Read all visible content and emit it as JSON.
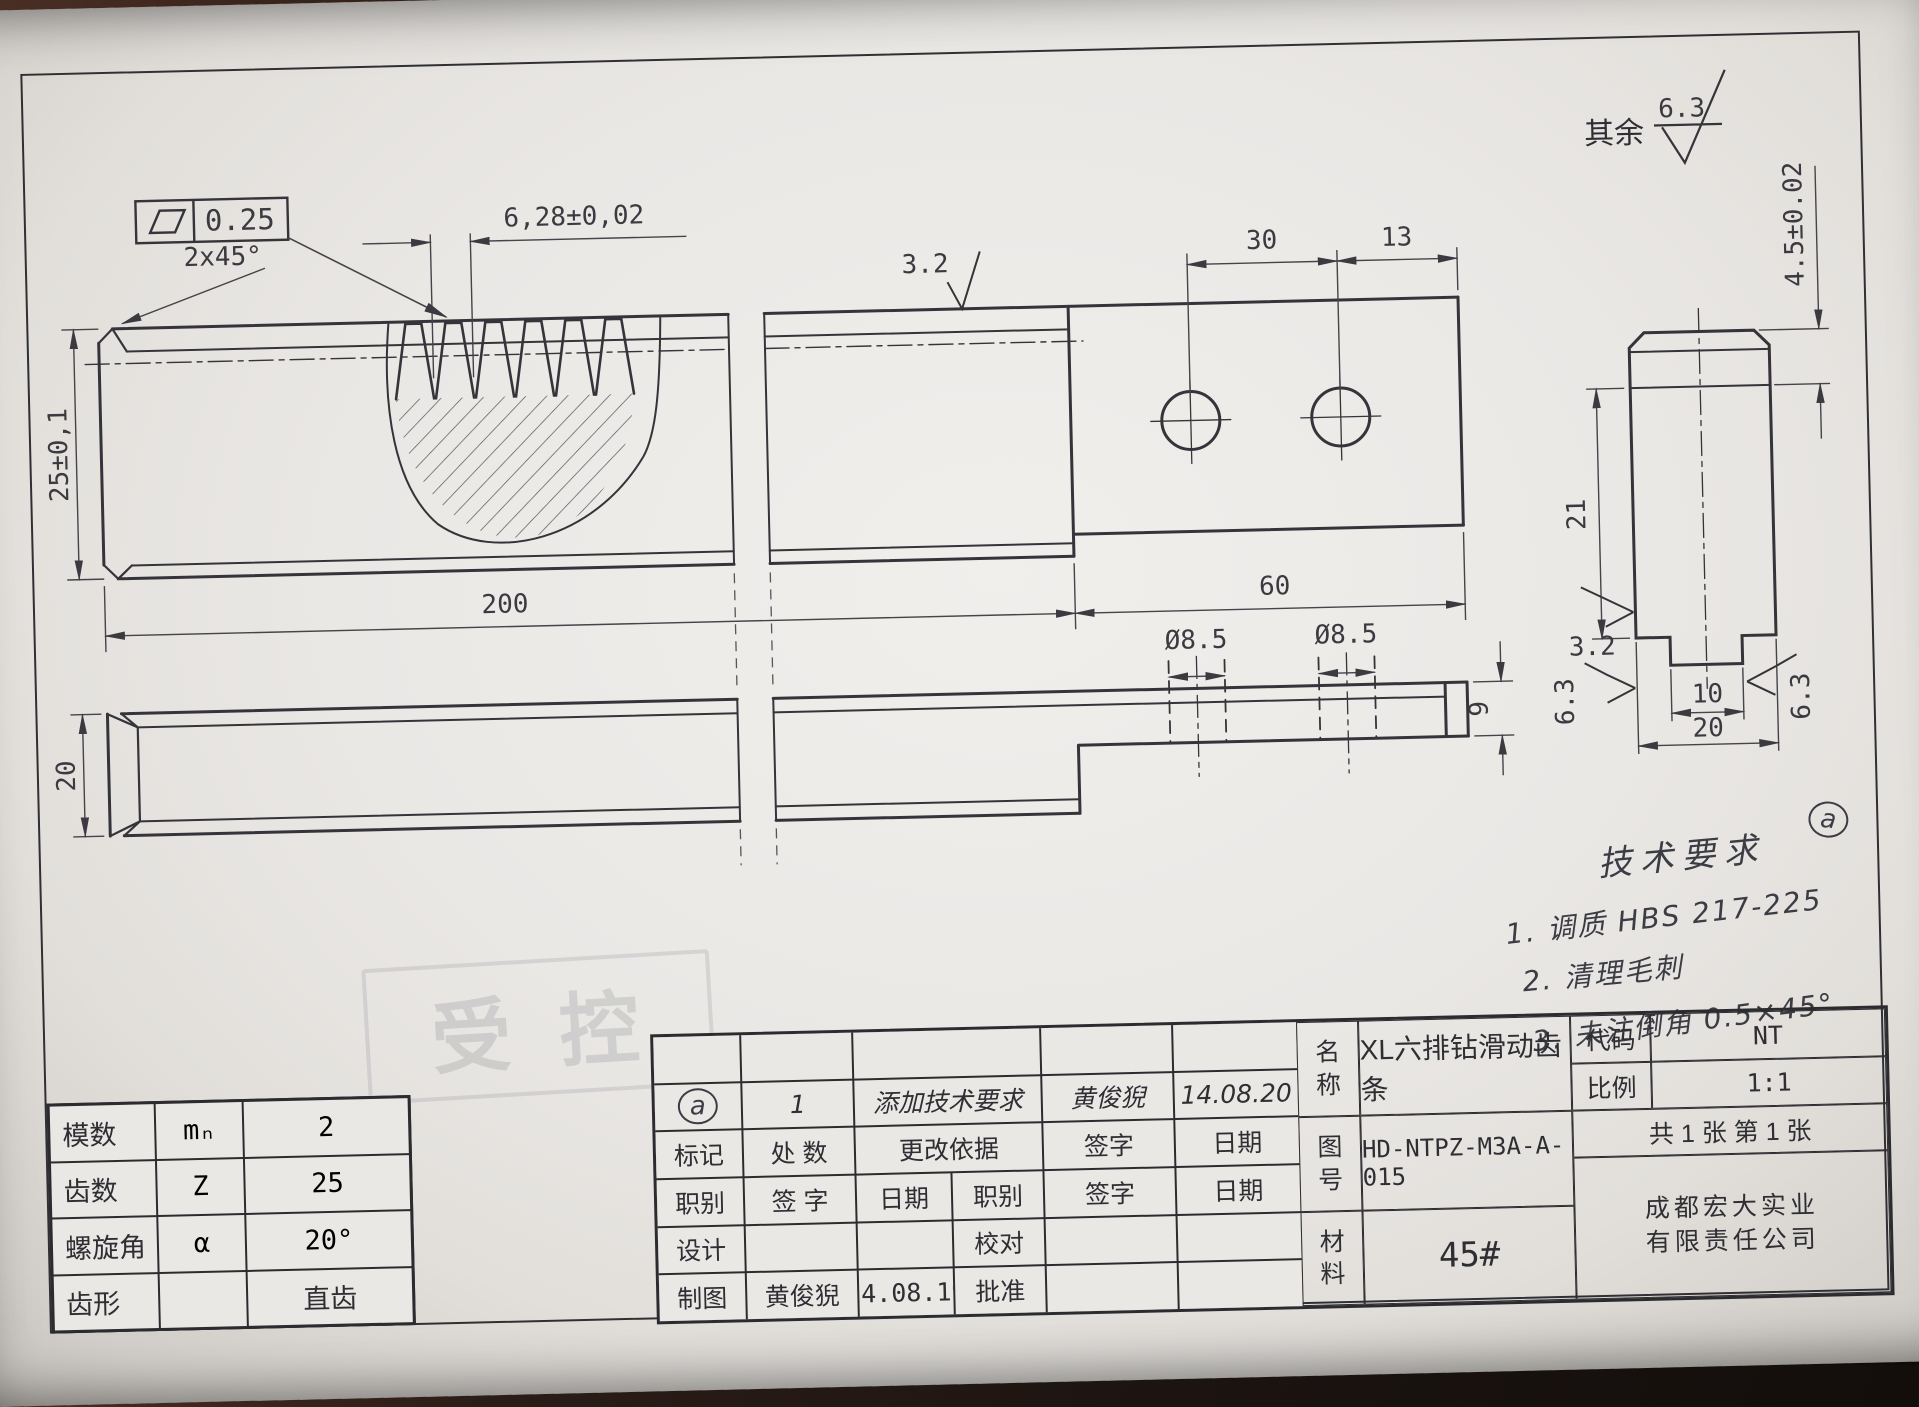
{
  "sheet": {
    "default_finish_prefix": "其余",
    "default_finish_value": "6.3",
    "stamp": "受控"
  },
  "flatness": {
    "value": "0.25"
  },
  "main_view": {
    "chamfer": "2x45°",
    "tooth_pitch": "6,28±0,02",
    "height": "25±0,1",
    "finish_top": "3.2",
    "hole_span": "30",
    "hole_to_edge": "13",
    "rack_length": "200",
    "tab_length": "60"
  },
  "bottom_view": {
    "depth": "20",
    "hole_dia_left": "Ø8.5",
    "hole_dia_right": "Ø8.5",
    "tab_thickness": "9"
  },
  "end_view": {
    "body_height": "21",
    "tooth_band": "4.5±0.02",
    "groove_width": "10",
    "width": "20",
    "finish_bottom": "3.2",
    "finish_left": "6.3",
    "finish_right": "6.3"
  },
  "notes": {
    "marker": "a",
    "title": "技术要求",
    "items": [
      "1. 调质 HBS 217-225",
      "2. 清理毛刺",
      "3. 未注倒角 0.5×45°"
    ]
  },
  "gear_table": {
    "rows": [
      {
        "name": "模数",
        "symbol": "mₙ",
        "value": "2"
      },
      {
        "name": "齿数",
        "symbol": "Z",
        "value": "25"
      },
      {
        "name": "螺旋角",
        "symbol": "α",
        "value": "20°"
      },
      {
        "name": "齿形",
        "symbol": "",
        "value": "直齿"
      }
    ]
  },
  "title_block": {
    "revision": {
      "marker": "a",
      "count": "1",
      "reason": "添加技术要求",
      "sign": "黄俊猊",
      "date": "14.08.20"
    },
    "headers": {
      "mark": "标记",
      "count": "处 数",
      "basis": "更改依据",
      "sign": "签字",
      "date": "日期",
      "role": "职别",
      "sign2": "签 字",
      "date2": "日期",
      "role2": "职别",
      "sign3": "签字",
      "date3": "日期"
    },
    "design_label": "设计",
    "check_label": "校对",
    "draw_label": "制图",
    "draw_name": "黄俊猊",
    "draw_date": "14.08.19",
    "approve_label": "批准",
    "name_label": "名称",
    "name_value": "XL六排钻滑动齿条",
    "code_label": "代码",
    "code_value": "NT",
    "scale_label": "比例",
    "scale_value": "1:1",
    "no_label": "图号",
    "no_value": "HD-NTPZ-M3A-A-015",
    "sheets": "共 1 张   第 1 张",
    "material_label": "材料",
    "material_value": "45#",
    "company_line1": "成都宏大实业",
    "company_line2": "有限责任公司"
  }
}
